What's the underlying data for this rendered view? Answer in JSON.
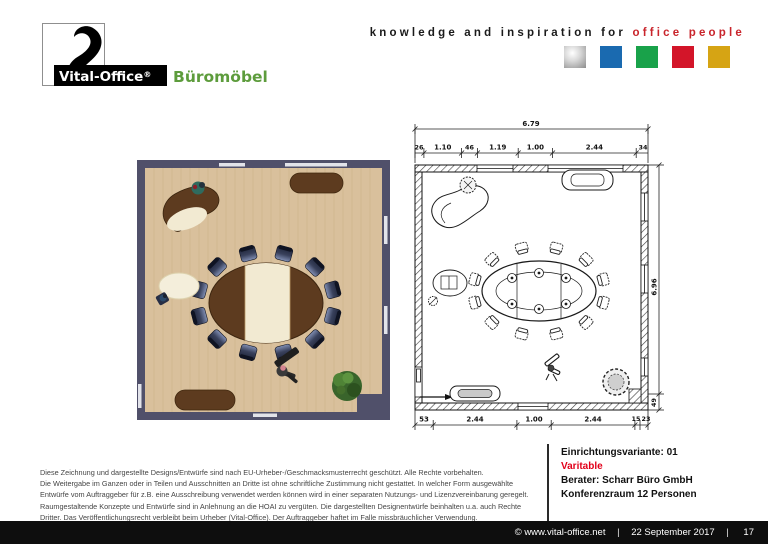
{
  "header": {
    "logo": {
      "brand": "Vital-Office",
      "reg": "®",
      "suffix": "Büromöbel",
      "suffix_color": "#5d9c3c"
    },
    "tagline_black": "knowledge and inspiration for",
    "tagline_red": "office people",
    "palette": {
      "silver": "#b9b9b9",
      "blue": "#1a6ab0",
      "green": "#19a24a",
      "red": "#d31529",
      "gold": "#d6a414"
    }
  },
  "plan": {
    "top_total": "6.79",
    "top": [
      "26",
      "1.10",
      "46",
      "1.19",
      "1.00",
      "2.44",
      "34"
    ],
    "bottom": [
      "53",
      "2.44",
      "1.00",
      "2.44",
      "15",
      "23"
    ],
    "right_total": "6.96",
    "right_seg": "49"
  },
  "footer": {
    "disclaimer": [
      "Diese Zeichnung und dargestellte Designs/Entwürfe sind nach EU-Urheber-/Geschmacksmusterrecht geschützt. Alle Rechte vorbehalten.",
      "Die Weitergabe im Ganzen oder in Teilen und Ausschnitten an Dritte ist ohne schriftliche Zustimmung nicht gestattet. In welcher Form ausgewählte",
      "Entwürfe vom Auftraggeber für z.B. eine Ausschreibung verwendet werden können wird in einer separaten Nutzungs- und Lizenzvereinbarung geregelt.",
      "Raumgestaltende Konzepte und Entwürfe sind in Anlehnung an die HOAI zu vergüten. Die dargestellten Designentwürfe beinhalten u.a. auch Rechte",
      "Dritter. Das Veröffentlichungsrecht verbleibt beim Urheber (Vital-Office). Der Auftraggeber haftet im Falle missbräuchlicher Verwendung."
    ],
    "info": {
      "variant": "Einrichtungsvariante: 01",
      "series": "Varitable",
      "consultant": "Berater: Scharr Büro GmbH",
      "room": "Konferenzraum 12 Personen"
    },
    "bar": {
      "site": "© www.vital-office.net",
      "sep": "|",
      "date": "22 September 2017",
      "page": "17"
    }
  }
}
